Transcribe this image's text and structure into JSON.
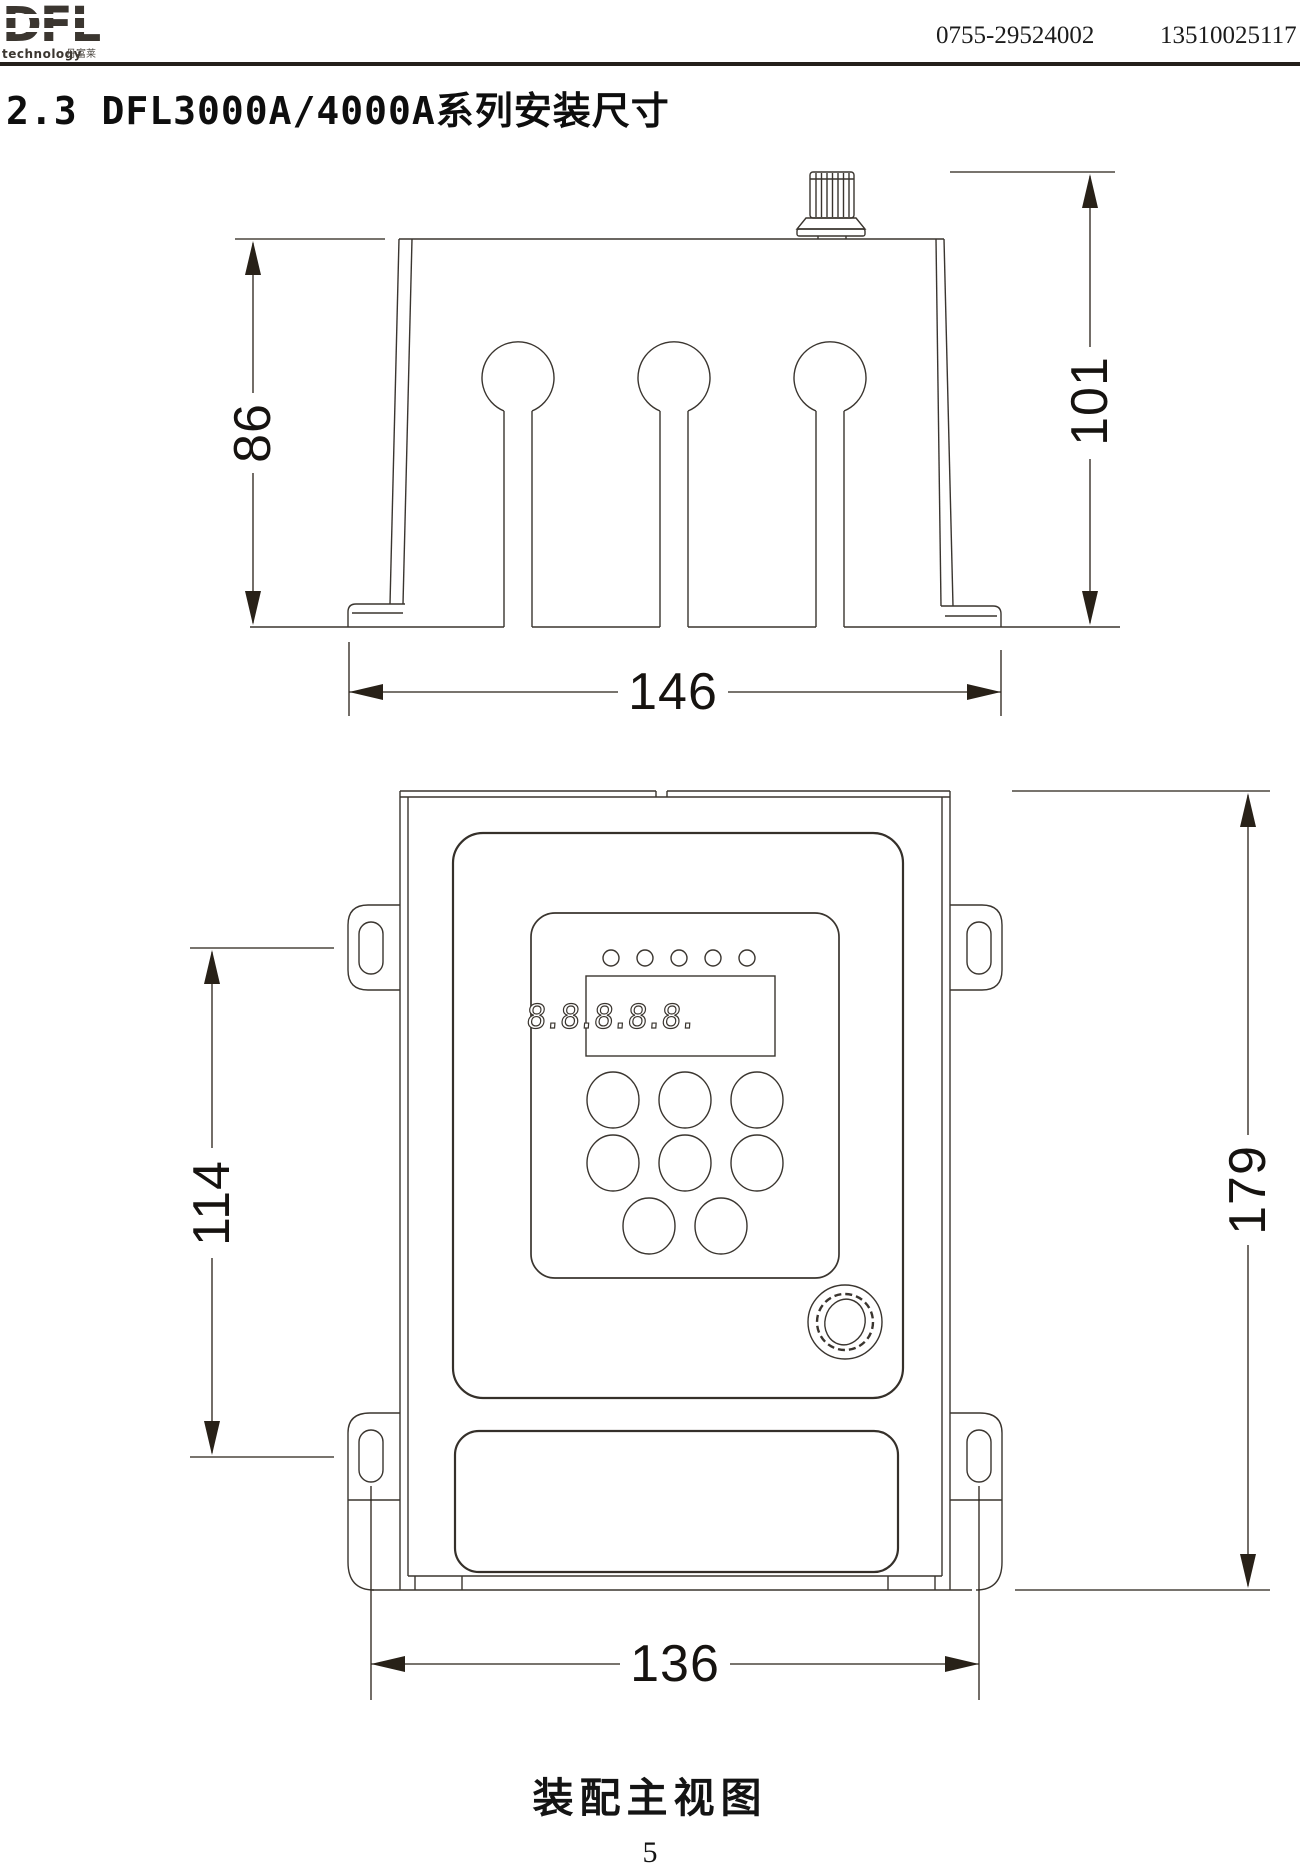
{
  "header": {
    "phone_left": "0755-29524002",
    "phone_right": "13510025117",
    "logo": {
      "name": "DFL",
      "tagline": "technology",
      "tagline_cn": "丹富莱"
    }
  },
  "title": "2.3 DFL3000A/4000A系列安装尺寸",
  "side_view": {
    "dim_body_height": "86",
    "dim_total_height": "101",
    "dim_width": "146"
  },
  "front_view": {
    "dim_hole_spacing_v": "114",
    "dim_total_height": "179",
    "dim_hole_spacing_h": "136",
    "display_text": "8.8.8.8.8."
  },
  "caption": "装配主视图",
  "page_number": "5",
  "colors": {
    "line": "#3a352f",
    "dim": "#282118",
    "accent": "#3b3630"
  }
}
